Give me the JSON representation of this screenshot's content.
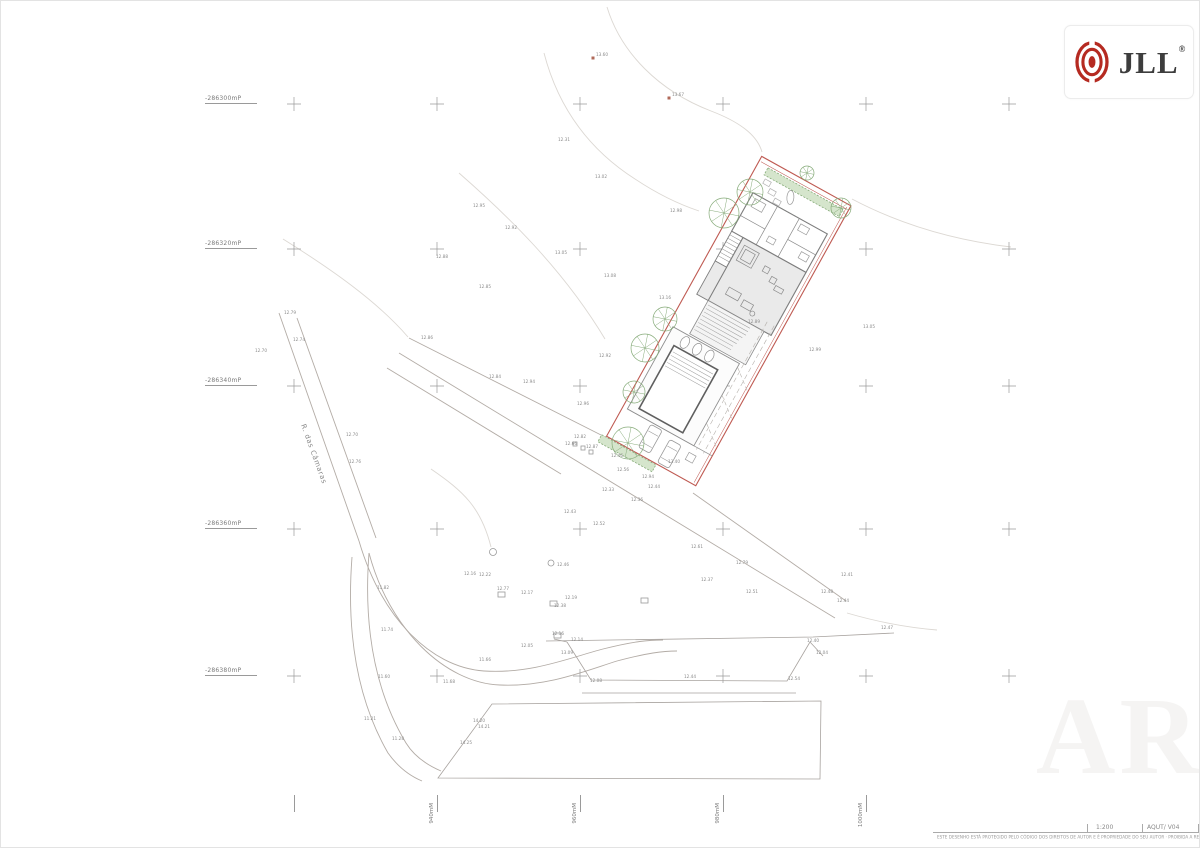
{
  "header": {
    "logo": {
      "brand": "JLL",
      "registered": "®"
    }
  },
  "grid": {
    "left_labels": [
      {
        "text": "-286300mP",
        "y": 103
      },
      {
        "text": "-286320mP",
        "y": 248
      },
      {
        "text": "-286340mP",
        "y": 385
      },
      {
        "text": "-286360mP",
        "y": 528
      },
      {
        "text": "-286380mP",
        "y": 675
      }
    ],
    "bottom_labels": [
      {
        "text": "940mM",
        "x": 436
      },
      {
        "text": "960mM",
        "x": 579
      },
      {
        "text": "980mM",
        "x": 722
      },
      {
        "text": "1000mM",
        "x": 865
      }
    ],
    "bottom_tick_xs": [
      293,
      436,
      579,
      722,
      865
    ],
    "cross_xs": [
      293,
      436,
      579,
      722,
      865,
      1008
    ],
    "cross_ys": [
      103,
      248,
      385,
      528,
      675
    ]
  },
  "road": {
    "name": "R. das Câmaras"
  },
  "title_block": {
    "scale": "1:200",
    "sheet_ref": "AQUT/ V04",
    "copyright": "ESTE DESENHO ESTÁ PROTEGIDO PELO CÓDIGO DOS DIREITOS DE AUTOR E É PROPRIEDADE DO SEU AUTOR · PROIBIDA A REPRODUÇÃO SEM PRÉVIA AUTORIZAÇÃO"
  },
  "watermark": "ARQ",
  "survey_points": [
    {
      "label": "13.60",
      "x": 592,
      "y": 57
    },
    {
      "label": "13.67",
      "x": 668,
      "y": 97
    }
  ],
  "spot_elevations": [
    {
      "v": "12.31",
      "x": 557,
      "y": 140
    },
    {
      "v": "13.02",
      "x": 594,
      "y": 177
    },
    {
      "v": "12.95",
      "x": 472,
      "y": 206
    },
    {
      "v": "12.92",
      "x": 504,
      "y": 228
    },
    {
      "v": "12.88",
      "x": 435,
      "y": 257
    },
    {
      "v": "13.05",
      "x": 554,
      "y": 253
    },
    {
      "v": "12.98",
      "x": 669,
      "y": 211
    },
    {
      "v": "13.08",
      "x": 603,
      "y": 276
    },
    {
      "v": "12.85",
      "x": 478,
      "y": 287
    },
    {
      "v": "13.16",
      "x": 658,
      "y": 298
    },
    {
      "v": "12.79",
      "x": 283,
      "y": 313
    },
    {
      "v": "12.74",
      "x": 292,
      "y": 340
    },
    {
      "v": "12.70",
      "x": 254,
      "y": 351
    },
    {
      "v": "12.70",
      "x": 345,
      "y": 435
    },
    {
      "v": "12.76",
      "x": 348,
      "y": 462
    },
    {
      "v": "12.86",
      "x": 420,
      "y": 338
    },
    {
      "v": "12.84",
      "x": 488,
      "y": 377
    },
    {
      "v": "12.94",
      "x": 522,
      "y": 382
    },
    {
      "v": "12.96",
      "x": 576,
      "y": 404
    },
    {
      "v": "12.92",
      "x": 598,
      "y": 356
    },
    {
      "v": "13.05",
      "x": 862,
      "y": 327
    },
    {
      "v": "12.99",
      "x": 808,
      "y": 350
    },
    {
      "v": "12.89",
      "x": 747,
      "y": 322
    },
    {
      "v": "12.82",
      "x": 573,
      "y": 437
    },
    {
      "v": "12.66",
      "x": 564,
      "y": 444
    },
    {
      "v": "12.87",
      "x": 585,
      "y": 447
    },
    {
      "v": "12.46",
      "x": 610,
      "y": 456
    },
    {
      "v": "12.56",
      "x": 616,
      "y": 470
    },
    {
      "v": "12.94",
      "x": 641,
      "y": 477
    },
    {
      "v": "12.44",
      "x": 647,
      "y": 487
    },
    {
      "v": "12.33",
      "x": 601,
      "y": 490
    },
    {
      "v": "12.36",
      "x": 630,
      "y": 500
    },
    {
      "v": "12.43",
      "x": 563,
      "y": 512
    },
    {
      "v": "12.52",
      "x": 592,
      "y": 524
    },
    {
      "v": "13.40",
      "x": 667,
      "y": 462
    },
    {
      "v": "12.61",
      "x": 690,
      "y": 547
    },
    {
      "v": "12.79",
      "x": 735,
      "y": 563
    },
    {
      "v": "12.37",
      "x": 700,
      "y": 580
    },
    {
      "v": "12.51",
      "x": 745,
      "y": 592
    },
    {
      "v": "12.48",
      "x": 820,
      "y": 592
    },
    {
      "v": "12.41",
      "x": 840,
      "y": 575
    },
    {
      "v": "12.44",
      "x": 836,
      "y": 601
    },
    {
      "v": "12.47",
      "x": 880,
      "y": 628
    },
    {
      "v": "12.16",
      "x": 463,
      "y": 574
    },
    {
      "v": "12.22",
      "x": 478,
      "y": 575
    },
    {
      "v": "12.77",
      "x": 496,
      "y": 589
    },
    {
      "v": "12.17",
      "x": 520,
      "y": 593
    },
    {
      "v": "12.38",
      "x": 553,
      "y": 606
    },
    {
      "v": "12.19",
      "x": 564,
      "y": 598
    },
    {
      "v": "12.46",
      "x": 556,
      "y": 565
    },
    {
      "v": "12.05",
      "x": 520,
      "y": 646
    },
    {
      "v": "12.16",
      "x": 551,
      "y": 634
    },
    {
      "v": "12.14",
      "x": 570,
      "y": 640
    },
    {
      "v": "13.09",
      "x": 560,
      "y": 653
    },
    {
      "v": "12.08",
      "x": 589,
      "y": 681
    },
    {
      "v": "12.44",
      "x": 683,
      "y": 677
    },
    {
      "v": "12.54",
      "x": 787,
      "y": 679
    },
    {
      "v": "12.40",
      "x": 806,
      "y": 641
    },
    {
      "v": "12.04",
      "x": 815,
      "y": 653
    },
    {
      "v": "11.82",
      "x": 376,
      "y": 588
    },
    {
      "v": "11.74",
      "x": 380,
      "y": 630
    },
    {
      "v": "11.60",
      "x": 377,
      "y": 677
    },
    {
      "v": "11.21",
      "x": 363,
      "y": 719
    },
    {
      "v": "11.66",
      "x": 478,
      "y": 660
    },
    {
      "v": "11.68",
      "x": 442,
      "y": 682
    },
    {
      "v": "11.28",
      "x": 391,
      "y": 739
    },
    {
      "v": "14.20",
      "x": 472,
      "y": 721
    },
    {
      "v": "14.21",
      "x": 477,
      "y": 727
    },
    {
      "v": "14.25",
      "x": 459,
      "y": 743
    }
  ],
  "colors": {
    "site_boundary": "#bf5a52",
    "vegetation": "#86ab79",
    "jll_red": "#b52a21",
    "line_gray": "#b0aaa6",
    "contour_gray": "#dcd8d3",
    "spot_text": "#8a8a8a"
  }
}
